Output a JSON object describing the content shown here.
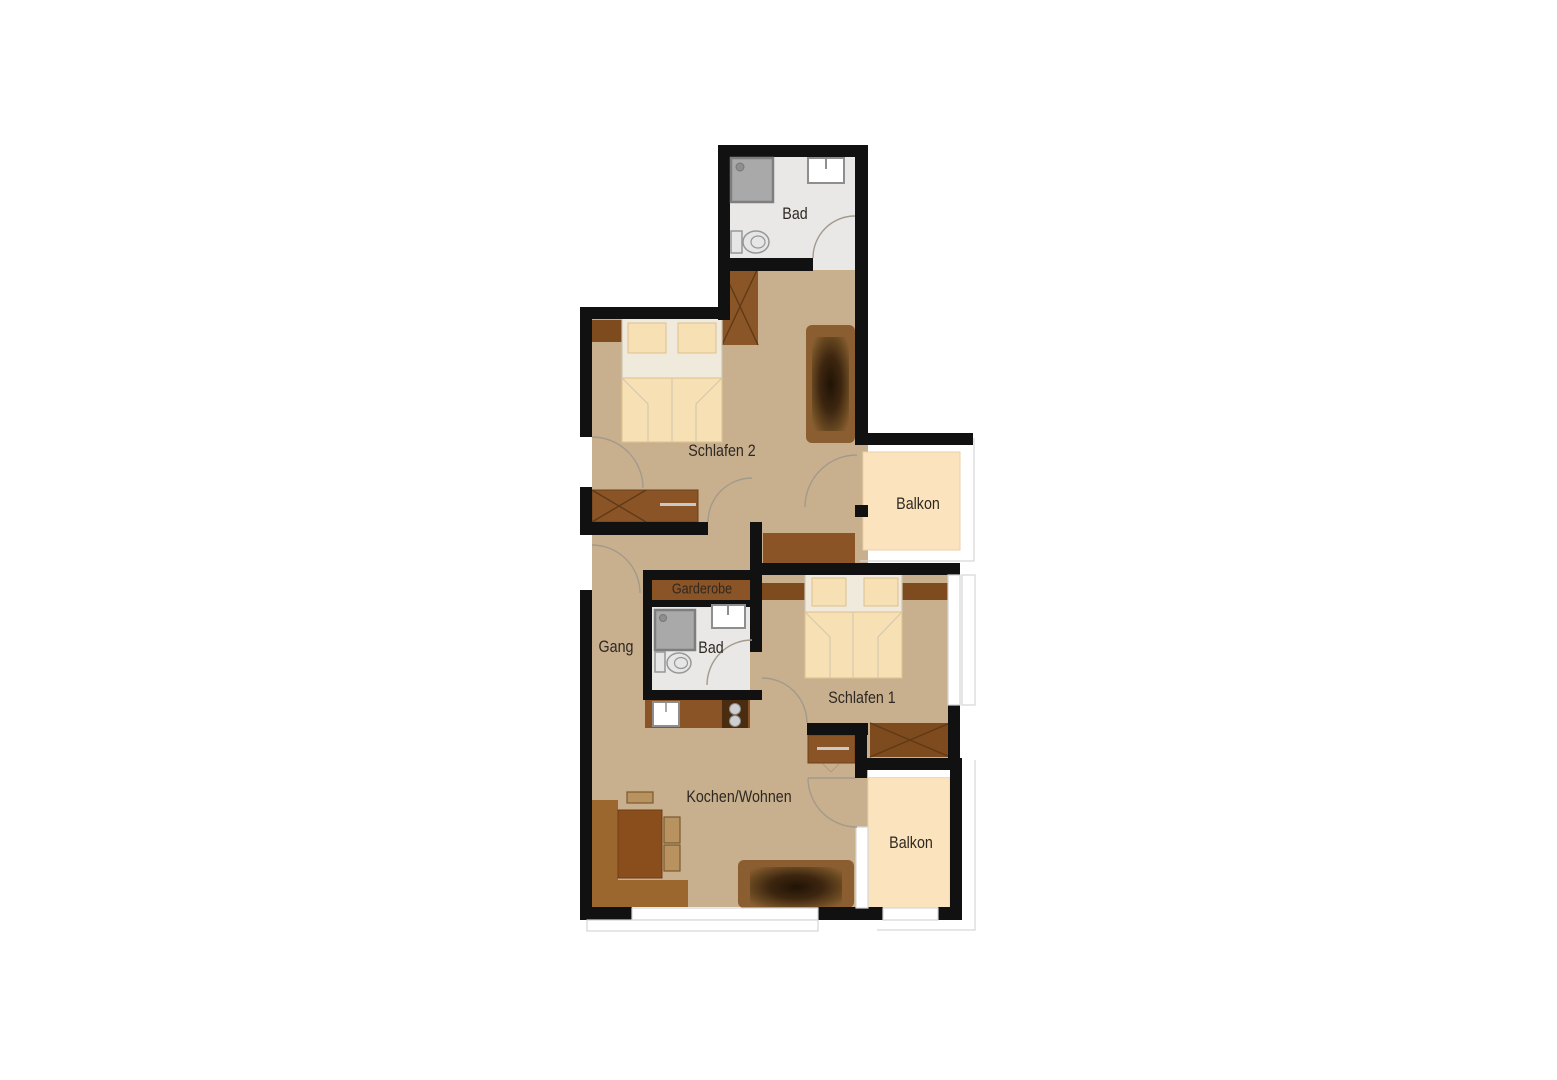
{
  "floorplan": {
    "title": "Apartment floor plan",
    "rooms": {
      "bad_top": {
        "label": "Bad"
      },
      "schlafen2": {
        "label": "Schlafen 2"
      },
      "balkon_top": {
        "label": "Balkon"
      },
      "garderobe": {
        "label": "Garderobe"
      },
      "gang": {
        "label": "Gang"
      },
      "bad_inner": {
        "label": "Bad"
      },
      "schlafen1": {
        "label": "Schlafen 1"
      },
      "kochen_wohnen": {
        "label": "Kochen/Wohnen"
      },
      "balkon_bottom": {
        "label": "Balkon"
      }
    },
    "colors": {
      "wall": "#111111",
      "floor_tan": "#c8af8e",
      "floor_bath": "#e9e8e6",
      "balcony": "#fbe3bd",
      "furniture": "#8a5427",
      "furniture_dark": "#7d4b1e",
      "bench": "#9c672e",
      "table": "#8a4e1c",
      "sofa": "#8a5e31",
      "bed_base": "#f0eadd",
      "bed_cream": "#f7e0b4",
      "arc": "#a39a8c",
      "frame": "#d6d6d6",
      "text": "#2e2822"
    }
  }
}
